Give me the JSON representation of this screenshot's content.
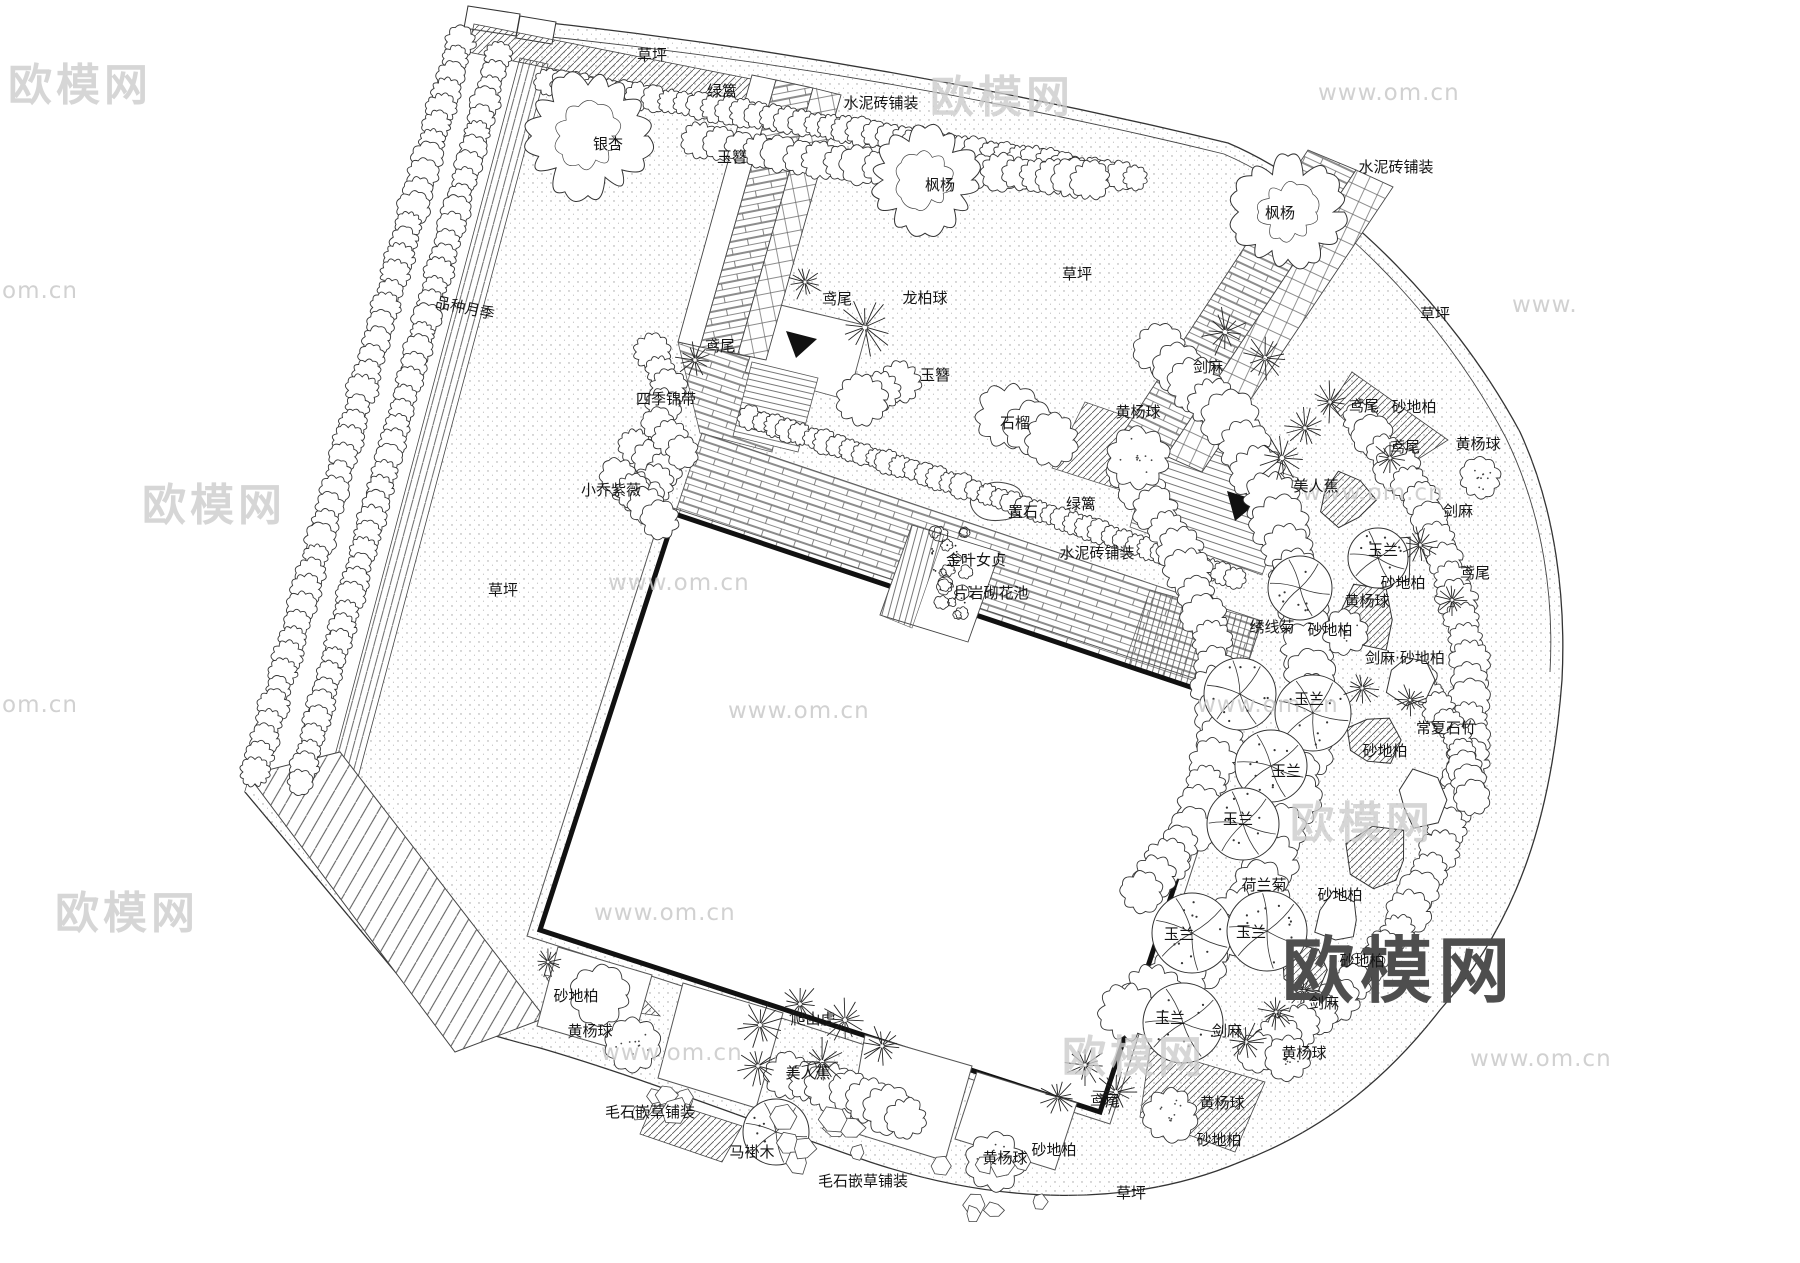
{
  "colors": {
    "ink": "#2a2a2a",
    "line": "#333333",
    "watermark_light": "#c9c9c9",
    "watermark_logo": "#4e4e4e",
    "paper": "#ffffff"
  },
  "labels": [
    {
      "text": "草坪",
      "x": 652,
      "y": 60
    },
    {
      "text": "绿篱",
      "x": 722,
      "y": 96
    },
    {
      "text": "水泥砖铺装",
      "x": 881,
      "y": 108
    },
    {
      "text": "银杏",
      "x": 608,
      "y": 149
    },
    {
      "text": "玉簪",
      "x": 732,
      "y": 162
    },
    {
      "text": "枫杨",
      "x": 940,
      "y": 190
    },
    {
      "text": "枫杨",
      "x": 1280,
      "y": 218
    },
    {
      "text": "水泥砖铺装",
      "x": 1396,
      "y": 172
    },
    {
      "text": "草坪",
      "x": 1077,
      "y": 279
    },
    {
      "text": "草坪",
      "x": 1435,
      "y": 319
    },
    {
      "text": "品种月季",
      "x": 464,
      "y": 313,
      "rot": 12
    },
    {
      "text": "鸢尾",
      "x": 837,
      "y": 304
    },
    {
      "text": "龙柏球",
      "x": 925,
      "y": 303
    },
    {
      "text": "鸢尾",
      "x": 720,
      "y": 351
    },
    {
      "text": "玉簪",
      "x": 935,
      "y": 380
    },
    {
      "text": "四季锦带",
      "x": 666,
      "y": 404
    },
    {
      "text": "黄杨球",
      "x": 1138,
      "y": 417
    },
    {
      "text": "石榴",
      "x": 1015,
      "y": 428
    },
    {
      "text": "剑麻",
      "x": 1208,
      "y": 372
    },
    {
      "text": "鸢尾",
      "x": 1364,
      "y": 411
    },
    {
      "text": "砂地柏",
      "x": 1414,
      "y": 412
    },
    {
      "text": "小乔紫薇",
      "x": 611,
      "y": 495
    },
    {
      "text": "草坪",
      "x": 503,
      "y": 595
    },
    {
      "text": "美人蕉",
      "x": 1316,
      "y": 491
    },
    {
      "text": "鸢尾",
      "x": 1405,
      "y": 452
    },
    {
      "text": "黄杨球",
      "x": 1478,
      "y": 449
    },
    {
      "text": "剑麻",
      "x": 1458,
      "y": 516
    },
    {
      "text": "鸢尾",
      "x": 1475,
      "y": 578
    },
    {
      "text": "置石",
      "x": 1023,
      "y": 517
    },
    {
      "text": "绿篱",
      "x": 1081,
      "y": 509
    },
    {
      "text": "水泥砖铺装",
      "x": 1097,
      "y": 558
    },
    {
      "text": "金叶女贞",
      "x": 976,
      "y": 565
    },
    {
      "text": "片岩砌花池",
      "x": 991,
      "y": 598
    },
    {
      "text": "玉兰",
      "x": 1383,
      "y": 555
    },
    {
      "text": "砂地柏",
      "x": 1403,
      "y": 588
    },
    {
      "text": "黄杨球",
      "x": 1367,
      "y": 606
    },
    {
      "text": "绣线菊",
      "x": 1272,
      "y": 632
    },
    {
      "text": "砂地柏",
      "x": 1330,
      "y": 635
    },
    {
      "text": "剑麻·砂地柏",
      "x": 1405,
      "y": 663
    },
    {
      "text": "玉兰",
      "x": 1309,
      "y": 704
    },
    {
      "text": "常夏石竹",
      "x": 1446,
      "y": 733
    },
    {
      "text": "砂地柏",
      "x": 1385,
      "y": 756
    },
    {
      "text": "玉兰",
      "x": 1286,
      "y": 776
    },
    {
      "text": "玉兰",
      "x": 1238,
      "y": 824
    },
    {
      "text": "荷兰菊",
      "x": 1264,
      "y": 890
    },
    {
      "text": "砂地柏",
      "x": 1340,
      "y": 900
    },
    {
      "text": "玉兰",
      "x": 1179,
      "y": 939
    },
    {
      "text": "玉兰",
      "x": 1251,
      "y": 937
    },
    {
      "text": "砂地柏",
      "x": 1362,
      "y": 966
    },
    {
      "text": "剑麻",
      "x": 1324,
      "y": 1008
    },
    {
      "text": "玉兰",
      "x": 1170,
      "y": 1023
    },
    {
      "text": "剑麻",
      "x": 1227,
      "y": 1036
    },
    {
      "text": "黄杨球",
      "x": 1304,
      "y": 1058
    },
    {
      "text": "鸢尾",
      "x": 1105,
      "y": 1106
    },
    {
      "text": "黄杨球",
      "x": 1222,
      "y": 1108
    },
    {
      "text": "砂地柏",
      "x": 1219,
      "y": 1145
    },
    {
      "text": "草坪",
      "x": 1131,
      "y": 1198
    },
    {
      "text": "砂地柏",
      "x": 576,
      "y": 1001
    },
    {
      "text": "黄杨球",
      "x": 590,
      "y": 1036
    },
    {
      "text": "毛石嵌草铺装",
      "x": 650,
      "y": 1117
    },
    {
      "text": "爬山虎",
      "x": 813,
      "y": 1024
    },
    {
      "text": "美人蕉",
      "x": 808,
      "y": 1078
    },
    {
      "text": "马褂木",
      "x": 752,
      "y": 1157
    },
    {
      "text": "毛石嵌草铺装",
      "x": 863,
      "y": 1186
    },
    {
      "text": "黄杨球",
      "x": 1005,
      "y": 1163
    },
    {
      "text": "砂地柏",
      "x": 1054,
      "y": 1155
    }
  ],
  "watermarks": [
    {
      "text": "欧模网",
      "x": 8,
      "y": 100,
      "kind": "lg"
    },
    {
      "text": "欧模网",
      "x": 930,
      "y": 112,
      "kind": "lg"
    },
    {
      "text": "www.om.cn",
      "x": 1318,
      "y": 100,
      "kind": "sm"
    },
    {
      "text": "om.cn",
      "x": 2,
      "y": 298,
      "kind": "sm"
    },
    {
      "text": "www.",
      "x": 1512,
      "y": 312,
      "kind": "sm"
    },
    {
      "text": "欧模网",
      "x": 142,
      "y": 520,
      "kind": "lg"
    },
    {
      "text": "www.om.cn",
      "x": 1302,
      "y": 500,
      "kind": "sm"
    },
    {
      "text": "www.om.cn",
      "x": 608,
      "y": 590,
      "kind": "sm"
    },
    {
      "text": "om.cn",
      "x": 2,
      "y": 712,
      "kind": "sm"
    },
    {
      "text": "www.om.cn",
      "x": 728,
      "y": 718,
      "kind": "sm"
    },
    {
      "text": "www.om.cn",
      "x": 1197,
      "y": 712,
      "kind": "sm"
    },
    {
      "text": "欧模网",
      "x": 55,
      "y": 928,
      "kind": "lg"
    },
    {
      "text": "www.om.cn",
      "x": 594,
      "y": 920,
      "kind": "sm"
    },
    {
      "text": "欧模网",
      "x": 1290,
      "y": 838,
      "kind": "lg"
    },
    {
      "text": "欧模网",
      "x": 1062,
      "y": 1072,
      "kind": "lg"
    },
    {
      "text": "www.om.cn",
      "x": 601,
      "y": 1060,
      "kind": "sm"
    },
    {
      "text": "www.om.cn",
      "x": 1470,
      "y": 1066,
      "kind": "sm"
    },
    {
      "text": "欧模网",
      "x": 1282,
      "y": 996,
      "kind": "xl"
    }
  ]
}
